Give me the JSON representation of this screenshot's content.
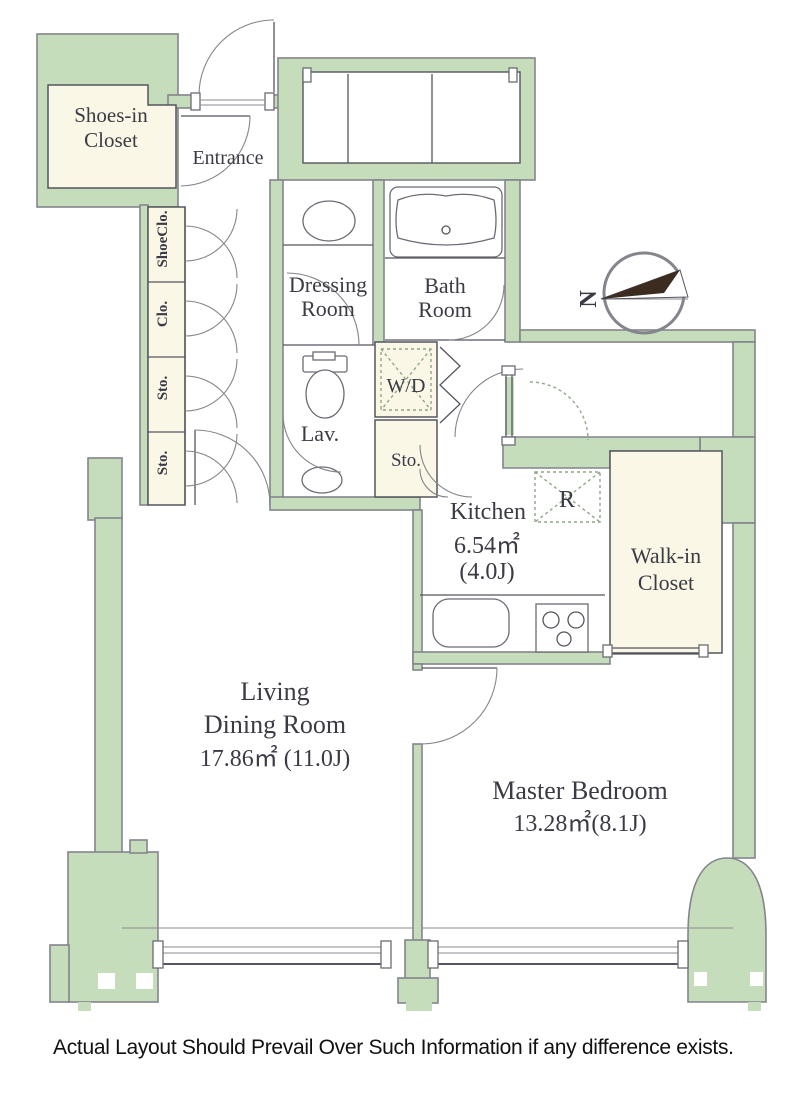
{
  "disclaimer": "Actual Layout Should Prevail Over Such Information if any difference exists.",
  "compass": {
    "north_label": "N"
  },
  "rooms": {
    "shoes_in_closet": {
      "line1": "Shoes-in",
      "line2": "Closet"
    },
    "entrance": {
      "label": "Entrance"
    },
    "shoe_closet": {
      "label": "ShoeClo."
    },
    "closet": {
      "label": "Clo."
    },
    "storage_upper": {
      "label": "Sto."
    },
    "storage_lower": {
      "label": "Sto."
    },
    "dressing_room": {
      "line1": "Dressing",
      "line2": "Room"
    },
    "bath_room": {
      "line1": "Bath",
      "line2": "Room"
    },
    "lavatory": {
      "label": "Lav."
    },
    "washer_dryer": {
      "label": "W/D"
    },
    "storage_hall": {
      "label": "Sto."
    },
    "kitchen": {
      "label": "Kitchen",
      "area_sqm": "6.54㎡",
      "area_jo": "(4.0J)"
    },
    "refrigerator": {
      "label": "R"
    },
    "walk_in_closet": {
      "line1": "Walk-in",
      "line2": "Closet"
    },
    "living_dining": {
      "line1": "Living",
      "line2": "Dining Room",
      "area": "17.86㎡ (11.0J)"
    },
    "master_bedroom": {
      "label": "Master Bedroom",
      "area": "13.28㎡(8.1J)"
    }
  },
  "colors": {
    "wall": "#c6ddbb",
    "cream": "#fbf7e6",
    "line": "#55555f",
    "wall_stroke": "#84848e",
    "needle": "#3c2b1f",
    "dash": "#8fa688"
  }
}
